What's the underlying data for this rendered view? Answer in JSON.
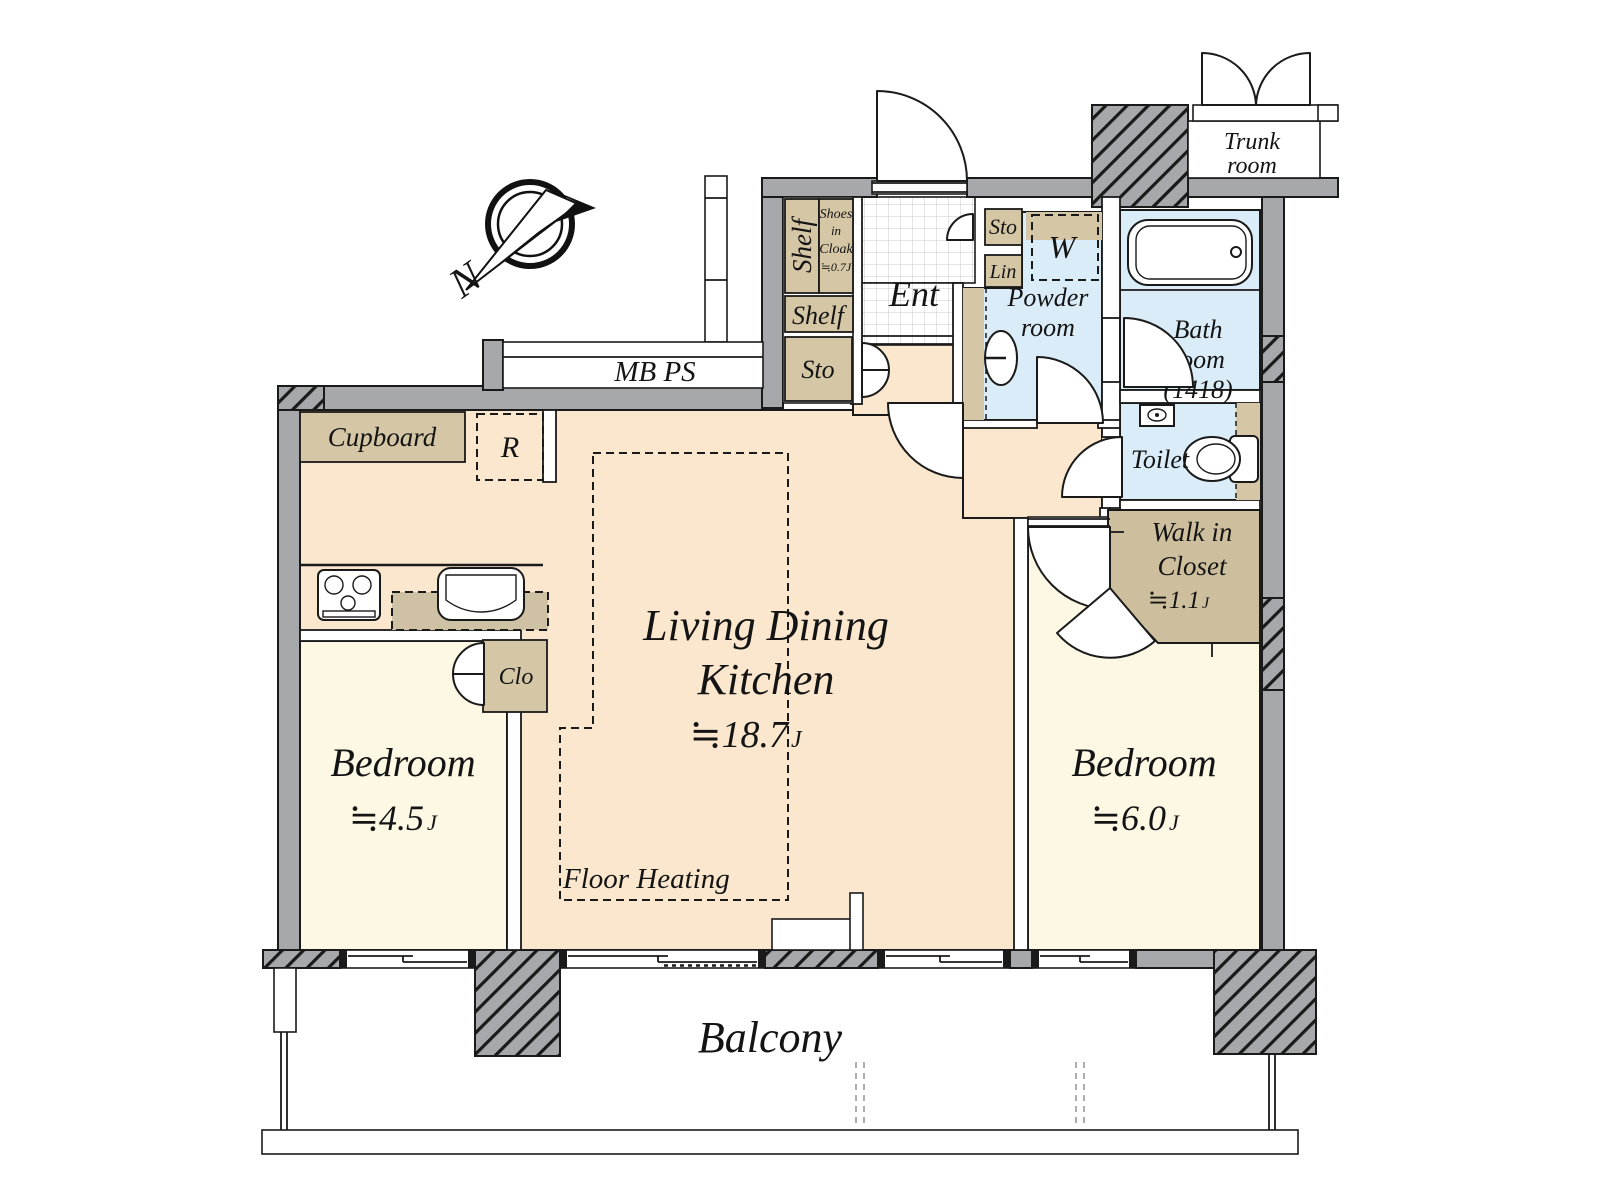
{
  "title": "2LDK apartment floor plan",
  "colors": {
    "floor_ldk": "#fae7ce",
    "floor_bedroom": "#fdf8e4",
    "floor_wet_area": "#d9ecf8",
    "fixture_tan": "#d5c7a6",
    "walk_in_closet_tan": "#cdbf9e",
    "wall_gray": "#a6a8ab",
    "line_black": "#1a1a1a",
    "balcony_white": "#ffffff"
  },
  "labels": {
    "north": "N",
    "mb_ps": "MB PS",
    "trunk": {
      "l1": "Trunk",
      "l2": "room"
    },
    "ent": {
      "title": "Ent",
      "shelf_vertical": "Shelf",
      "shelf_horizontal": "Shelf",
      "sto_upper": "Sto",
      "sto_lower": "Sto",
      "lin": "Lin",
      "shoes": {
        "l1": "Shoes",
        "l2": "in",
        "l3": "Cloak",
        "l4": "≒0.7J"
      }
    },
    "powder": {
      "l1": "Powder",
      "l2": "room",
      "washer": "W"
    },
    "bath": {
      "l1": "Bath",
      "l2": "room",
      "l3": "(1418)"
    },
    "toilet": "Toilet",
    "wic": {
      "l1": "Walk in",
      "l2": "Closet",
      "size": "≒1.1",
      "unit": "J"
    },
    "ldk": {
      "l1": "Living Dining",
      "l2": "Kitchen",
      "size": "≒18.7",
      "unit": "J",
      "cupboard": "Cupboard",
      "fridge": "R",
      "floor_heating": "Floor Heating"
    },
    "bedroom_small": {
      "name": "Bedroom",
      "size": "≒4.5",
      "unit": "J",
      "closet": "Clo"
    },
    "bedroom_large": {
      "name": "Bedroom",
      "size": "≒6.0",
      "unit": "J"
    },
    "balcony": "Balcony"
  }
}
